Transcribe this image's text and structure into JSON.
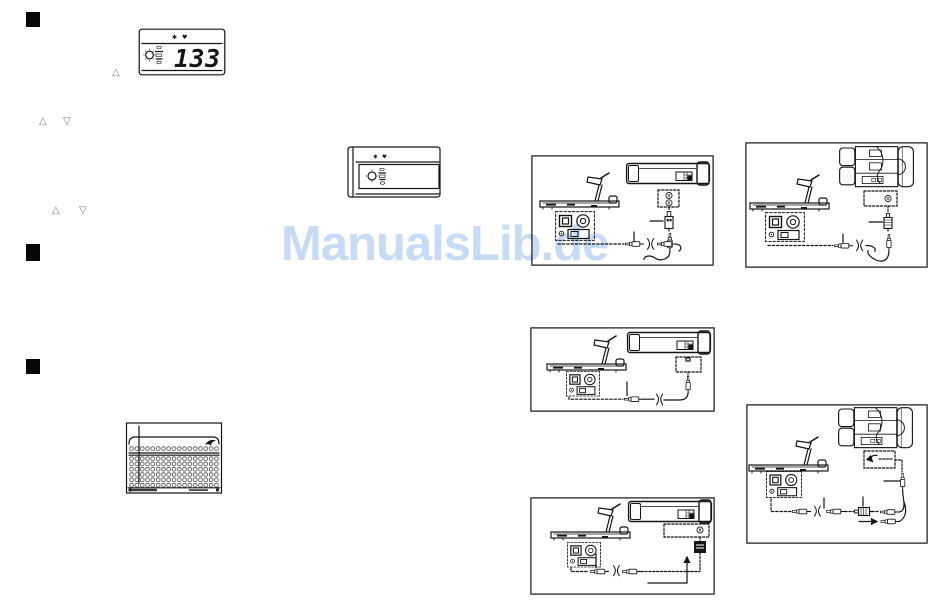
{
  "watermark": {
    "text": "ManualsLib.de",
    "color": "#c7dbf4"
  },
  "console_display": {
    "value": "133",
    "speed_icon": "✱",
    "heart_icon": "♥"
  },
  "blank_console": {
    "speed_icon": "✱",
    "heart_icon": "♥"
  },
  "buttons": {
    "up_arrow": "△",
    "down_arrow": "▽"
  }
}
